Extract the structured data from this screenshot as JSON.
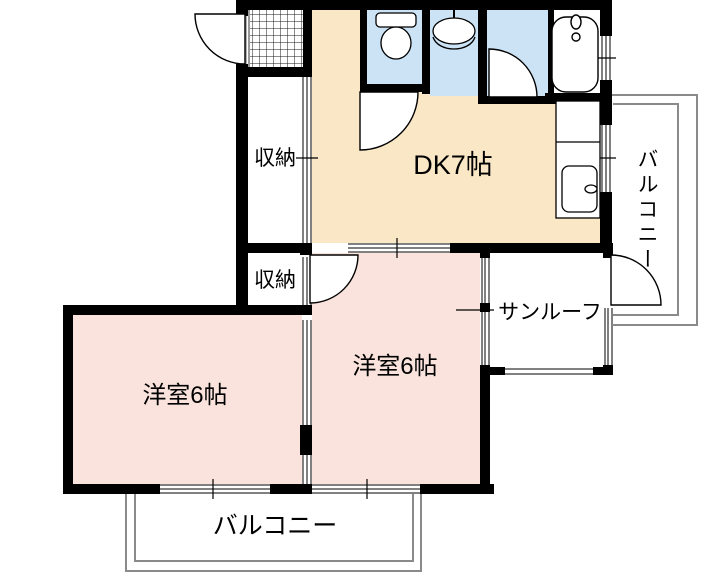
{
  "plan": {
    "labels": {
      "dk": "DK7帖",
      "closet_upper": "収納",
      "closet_lower": "収納",
      "bedroom_left": "洋室6帖",
      "bedroom_right": "洋室6帖",
      "sunroom": "サンルーフ",
      "balcony_right": "バルコニー",
      "balcony_bottom": "バルコニー"
    },
    "colors": {
      "dk_fill": "#FAE7C6",
      "bedroom_fill": "#F9E3DC",
      "wet_fill": "#CBE3F5",
      "wall": "#000000",
      "rail": "#8A8A8A"
    }
  }
}
